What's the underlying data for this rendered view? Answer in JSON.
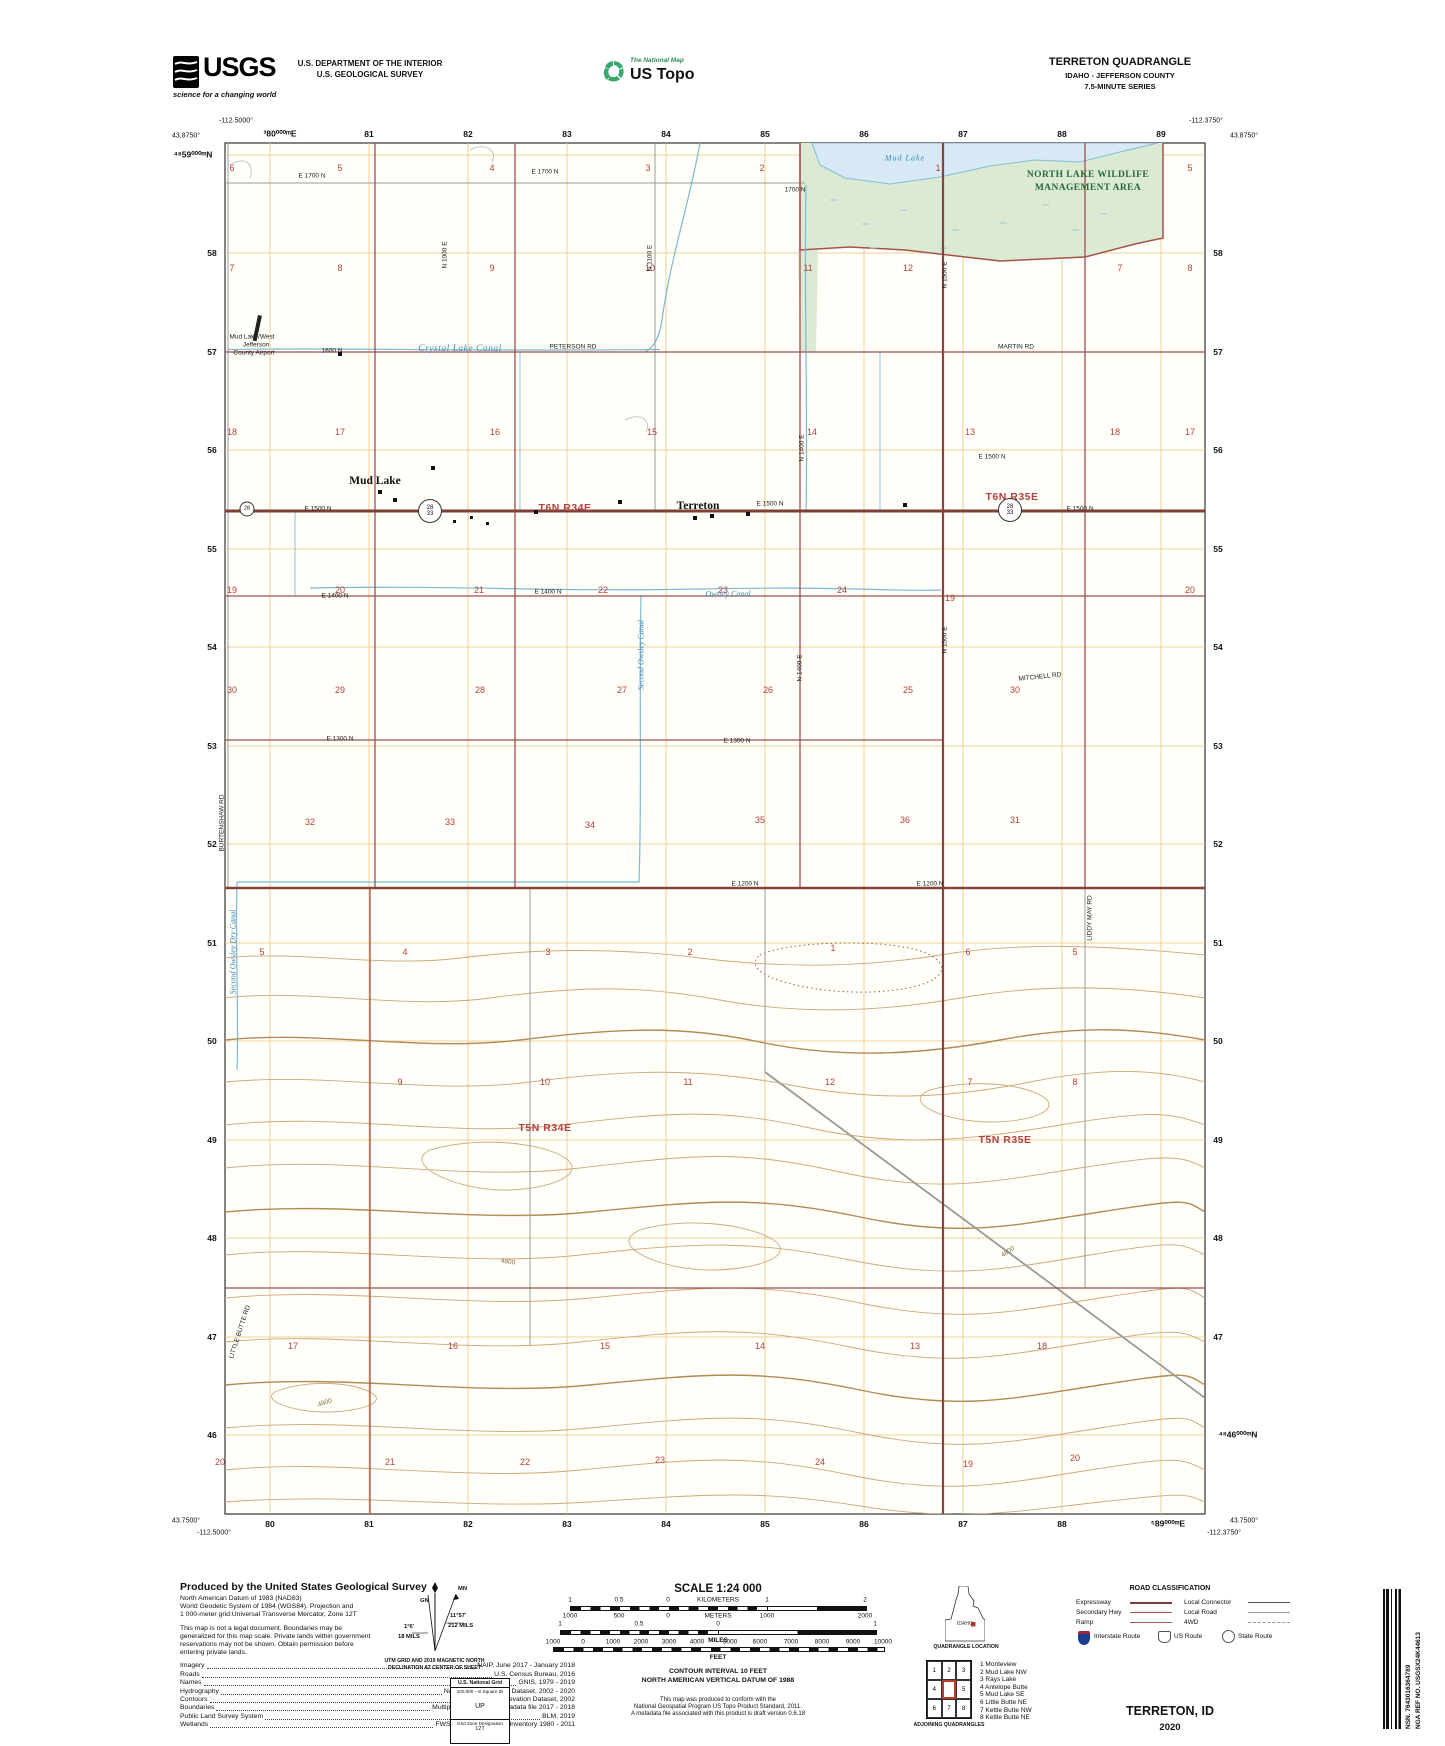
{
  "header": {
    "usgs_logo": "USGS",
    "usgs_tagline": "science for a changing world",
    "dept_line1": "U.S. DEPARTMENT OF THE INTERIOR",
    "dept_line2": "U.S. GEOLOGICAL SURVEY",
    "natmap_small": "The National Map",
    "natmap_big": "US Topo",
    "quad_title": "TERRETON QUADRANGLE",
    "quad_sub1": "IDAHO - JEFFERSON COUNTY",
    "quad_sub2": "7.5-MINUTE SERIES"
  },
  "map": {
    "corner_coords": [
      {
        "t": "-112.5000°",
        "x": 236,
        "y": 121
      },
      {
        "t": "43.8750°",
        "x": 186,
        "y": 136
      },
      {
        "t": "-112.3750°",
        "x": 1206,
        "y": 121
      },
      {
        "t": "43.8750°",
        "x": 1244,
        "y": 136
      },
      {
        "t": "43.7500°",
        "x": 186,
        "y": 1521
      },
      {
        "t": "-112.5000°",
        "x": 214,
        "y": 1533
      },
      {
        "t": "43.7500°",
        "x": 1244,
        "y": 1521
      },
      {
        "t": "-112.3750°",
        "x": 1224,
        "y": 1533
      }
    ],
    "grid_labels": [
      {
        "t": "³80⁰⁰⁰ᵐE",
        "x": 280,
        "y": 134
      },
      {
        "t": "81",
        "x": 369,
        "y": 134
      },
      {
        "t": "82",
        "x": 468,
        "y": 134
      },
      {
        "t": "83",
        "x": 567,
        "y": 134
      },
      {
        "t": "84",
        "x": 666,
        "y": 134
      },
      {
        "t": "85",
        "x": 765,
        "y": 134
      },
      {
        "t": "86",
        "x": 864,
        "y": 134
      },
      {
        "t": "87",
        "x": 963,
        "y": 134
      },
      {
        "t": "88",
        "x": 1062,
        "y": 134
      },
      {
        "t": "89",
        "x": 1161,
        "y": 134
      },
      {
        "t": "80",
        "x": 270,
        "y": 1524
      },
      {
        "t": "81",
        "x": 369,
        "y": 1524
      },
      {
        "t": "82",
        "x": 468,
        "y": 1524
      },
      {
        "t": "83",
        "x": 567,
        "y": 1524
      },
      {
        "t": "84",
        "x": 666,
        "y": 1524
      },
      {
        "t": "85",
        "x": 765,
        "y": 1524
      },
      {
        "t": "86",
        "x": 864,
        "y": 1524
      },
      {
        "t": "87",
        "x": 963,
        "y": 1524
      },
      {
        "t": "88",
        "x": 1062,
        "y": 1524
      },
      {
        "t": "⁵89⁰⁰⁰ᵐE",
        "x": 1168,
        "y": 1524
      },
      {
        "t": "⁴⁸59⁰⁰⁰ᵐN",
        "x": 193,
        "y": 155
      },
      {
        "t": "58",
        "x": 212,
        "y": 253
      },
      {
        "t": "57",
        "x": 212,
        "y": 352
      },
      {
        "t": "56",
        "x": 212,
        "y": 450
      },
      {
        "t": "55",
        "x": 212,
        "y": 549
      },
      {
        "t": "54",
        "x": 212,
        "y": 647
      },
      {
        "t": "53",
        "x": 212,
        "y": 746
      },
      {
        "t": "52",
        "x": 212,
        "y": 844
      },
      {
        "t": "51",
        "x": 212,
        "y": 943
      },
      {
        "t": "50",
        "x": 212,
        "y": 1041
      },
      {
        "t": "49",
        "x": 212,
        "y": 1140
      },
      {
        "t": "48",
        "x": 212,
        "y": 1238
      },
      {
        "t": "47",
        "x": 212,
        "y": 1337
      },
      {
        "t": "46",
        "x": 212,
        "y": 1435
      },
      {
        "t": "58",
        "x": 1218,
        "y": 253
      },
      {
        "t": "57",
        "x": 1218,
        "y": 352
      },
      {
        "t": "56",
        "x": 1218,
        "y": 450
      },
      {
        "t": "55",
        "x": 1218,
        "y": 549
      },
      {
        "t": "54",
        "x": 1218,
        "y": 647
      },
      {
        "t": "53",
        "x": 1218,
        "y": 746
      },
      {
        "t": "52",
        "x": 1218,
        "y": 844
      },
      {
        "t": "51",
        "x": 1218,
        "y": 943
      },
      {
        "t": "50",
        "x": 1218,
        "y": 1041
      },
      {
        "t": "49",
        "x": 1218,
        "y": 1140
      },
      {
        "t": "48",
        "x": 1218,
        "y": 1238
      },
      {
        "t": "47",
        "x": 1218,
        "y": 1337
      },
      {
        "t": "⁴⁸46⁰⁰⁰ᵐN",
        "x": 1238,
        "y": 1435
      }
    ],
    "sections": [
      {
        "t": "6",
        "x": 232,
        "y": 168
      },
      {
        "t": "5",
        "x": 340,
        "y": 168
      },
      {
        "t": "4",
        "x": 492,
        "y": 168
      },
      {
        "t": "3",
        "x": 648,
        "y": 168
      },
      {
        "t": "2",
        "x": 762,
        "y": 168
      },
      {
        "t": "1",
        "x": 938,
        "y": 168
      },
      {
        "t": "5",
        "x": 1190,
        "y": 168
      },
      {
        "t": "7",
        "x": 232,
        "y": 268
      },
      {
        "t": "8",
        "x": 340,
        "y": 268
      },
      {
        "t": "9",
        "x": 492,
        "y": 268
      },
      {
        "t": "10",
        "x": 650,
        "y": 268
      },
      {
        "t": "11",
        "x": 808,
        "y": 268
      },
      {
        "t": "12",
        "x": 908,
        "y": 268
      },
      {
        "t": "7",
        "x": 1120,
        "y": 268
      },
      {
        "t": "8",
        "x": 1190,
        "y": 268
      },
      {
        "t": "18",
        "x": 232,
        "y": 432
      },
      {
        "t": "17",
        "x": 340,
        "y": 432
      },
      {
        "t": "16",
        "x": 495,
        "y": 432
      },
      {
        "t": "15",
        "x": 652,
        "y": 432
      },
      {
        "t": "14",
        "x": 812,
        "y": 432
      },
      {
        "t": "13",
        "x": 970,
        "y": 432
      },
      {
        "t": "18",
        "x": 1115,
        "y": 432
      },
      {
        "t": "17",
        "x": 1190,
        "y": 432
      },
      {
        "t": "19",
        "x": 232,
        "y": 590
      },
      {
        "t": "20",
        "x": 340,
        "y": 590
      },
      {
        "t": "21",
        "x": 479,
        "y": 590
      },
      {
        "t": "22",
        "x": 603,
        "y": 590
      },
      {
        "t": "23",
        "x": 723,
        "y": 590
      },
      {
        "t": "24",
        "x": 842,
        "y": 590
      },
      {
        "t": "19",
        "x": 950,
        "y": 598
      },
      {
        "t": "20",
        "x": 1190,
        "y": 590
      },
      {
        "t": "30",
        "x": 232,
        "y": 690
      },
      {
        "t": "29",
        "x": 340,
        "y": 690
      },
      {
        "t": "28",
        "x": 480,
        "y": 690
      },
      {
        "t": "27",
        "x": 622,
        "y": 690
      },
      {
        "t": "26",
        "x": 768,
        "y": 690
      },
      {
        "t": "25",
        "x": 908,
        "y": 690
      },
      {
        "t": "30",
        "x": 1015,
        "y": 690
      },
      {
        "t": "32",
        "x": 310,
        "y": 822
      },
      {
        "t": "33",
        "x": 450,
        "y": 822
      },
      {
        "t": "34",
        "x": 590,
        "y": 825
      },
      {
        "t": "35",
        "x": 760,
        "y": 820
      },
      {
        "t": "36",
        "x": 905,
        "y": 820
      },
      {
        "t": "31",
        "x": 1015,
        "y": 820
      },
      {
        "t": "5",
        "x": 262,
        "y": 952
      },
      {
        "t": "4",
        "x": 405,
        "y": 952
      },
      {
        "t": "3",
        "x": 548,
        "y": 952
      },
      {
        "t": "2",
        "x": 690,
        "y": 952
      },
      {
        "t": "1",
        "x": 833,
        "y": 948
      },
      {
        "t": "6",
        "x": 968,
        "y": 952
      },
      {
        "t": "5",
        "x": 1075,
        "y": 952
      },
      {
        "t": "9",
        "x": 400,
        "y": 1082
      },
      {
        "t": "10",
        "x": 545,
        "y": 1082
      },
      {
        "t": "11",
        "x": 688,
        "y": 1082
      },
      {
        "t": "12",
        "x": 830,
        "y": 1082
      },
      {
        "t": "7",
        "x": 970,
        "y": 1082
      },
      {
        "t": "8",
        "x": 1075,
        "y": 1082
      },
      {
        "t": "17",
        "x": 293,
        "y": 1346
      },
      {
        "t": "16",
        "x": 453,
        "y": 1346
      },
      {
        "t": "15",
        "x": 605,
        "y": 1346
      },
      {
        "t": "14",
        "x": 760,
        "y": 1346
      },
      {
        "t": "13",
        "x": 915,
        "y": 1346
      },
      {
        "t": "18",
        "x": 1042,
        "y": 1346
      },
      {
        "t": "20",
        "x": 220,
        "y": 1462
      },
      {
        "t": "21",
        "x": 390,
        "y": 1462
      },
      {
        "t": "22",
        "x": 525,
        "y": 1462
      },
      {
        "t": "23",
        "x": 660,
        "y": 1460
      },
      {
        "t": "24",
        "x": 820,
        "y": 1462
      },
      {
        "t": "19",
        "x": 968,
        "y": 1464
      },
      {
        "t": "20",
        "x": 1075,
        "y": 1458
      }
    ],
    "townships": [
      {
        "t": "T6N R34E",
        "x": 565,
        "y": 508
      },
      {
        "t": "T6N R35E",
        "x": 1012,
        "y": 497
      },
      {
        "t": "T5N R34E",
        "x": 545,
        "y": 1128
      },
      {
        "t": "T5N R35E",
        "x": 1005,
        "y": 1140
      }
    ],
    "places": [
      {
        "t": "Mud Lake",
        "x": 375,
        "y": 481
      },
      {
        "t": "Terreton",
        "x": 698,
        "y": 506
      }
    ],
    "water": [
      {
        "t": "Mud Lake",
        "x": 905,
        "y": 158,
        "c": "lake"
      },
      {
        "t": "Crystal Lake Canal",
        "x": 460,
        "y": 349,
        "c": "canalbig"
      },
      {
        "t": "Owsley Canal",
        "x": 728,
        "y": 594,
        "c": "canal"
      },
      {
        "t": "Second Owsley Canal",
        "x": 641,
        "y": 655,
        "c": "canal",
        "r": -90
      },
      {
        "t": "Second Owsley Dry Canal",
        "x": 233,
        "y": 952,
        "c": "canal",
        "r": -90
      }
    ],
    "areas": [
      {
        "t": "NORTH LAKE WILDLIFE",
        "x": 1088,
        "y": 175
      },
      {
        "t": "MANAGEMENT AREA",
        "x": 1088,
        "y": 188
      }
    ],
    "roads": [
      {
        "t": "E 1700 N",
        "x": 312,
        "y": 176
      },
      {
        "t": "E 1700 N",
        "x": 545,
        "y": 172
      },
      {
        "t": "1700 N",
        "x": 795,
        "y": 190
      },
      {
        "t": "Mud Lake/West",
        "x": 252,
        "y": 337
      },
      {
        "t": "Jefferson",
        "x": 256,
        "y": 345
      },
      {
        "t": "County Airport",
        "x": 254,
        "y": 353
      },
      {
        "t": "1600 N",
        "x": 332,
        "y": 351
      },
      {
        "t": "PETERSON RD",
        "x": 573,
        "y": 347
      },
      {
        "t": "MARTIN RD",
        "x": 1016,
        "y": 347
      },
      {
        "t": "E 1500 N",
        "x": 318,
        "y": 509
      },
      {
        "t": "E 1500 N",
        "x": 770,
        "y": 504
      },
      {
        "t": "E 1500 N",
        "x": 1080,
        "y": 509
      },
      {
        "t": "E 1500 N",
        "x": 992,
        "y": 457
      },
      {
        "t": "E 1400 N",
        "x": 335,
        "y": 596
      },
      {
        "t": "E 1400 N",
        "x": 548,
        "y": 592
      },
      {
        "t": "E 1300 N",
        "x": 340,
        "y": 739
      },
      {
        "t": "E 1300 N",
        "x": 737,
        "y": 741
      },
      {
        "t": "E 1200 N",
        "x": 930,
        "y": 884
      },
      {
        "t": "E 1200 N",
        "x": 745,
        "y": 884
      },
      {
        "t": "MITCHELL RD",
        "x": 1040,
        "y": 677,
        "r": -6
      },
      {
        "t": "BURTENSHAW RD",
        "x": 222,
        "y": 823,
        "r": -90
      },
      {
        "t": "LIDDY MAY RD",
        "x": 1090,
        "y": 918,
        "r": -90
      },
      {
        "t": "LITTLE BUTTE RD",
        "x": 240,
        "y": 1332,
        "r": -72
      },
      {
        "t": "N 1000 E",
        "x": 445,
        "y": 255,
        "r": -90
      },
      {
        "t": "N 1100 E",
        "x": 650,
        "y": 258,
        "r": -90
      },
      {
        "t": "N 1400 E",
        "x": 802,
        "y": 448,
        "r": -90
      },
      {
        "t": "N 1500 E",
        "x": 945,
        "y": 275,
        "r": -90
      },
      {
        "t": "N 1400 E",
        "x": 800,
        "y": 668,
        "r": -90
      },
      {
        "t": "N 1500 E",
        "x": 945,
        "y": 640,
        "r": -90
      }
    ],
    "contour_labels": [
      {
        "t": "4800",
        "x": 508,
        "y": 1262,
        "r": 8
      },
      {
        "t": "4900",
        "x": 325,
        "y": 1403,
        "r": -20
      },
      {
        "t": "4800",
        "x": 1008,
        "y": 1252,
        "r": -35
      }
    ],
    "shields": {
      "a_top": "28",
      "a_bot": "33",
      "b_top": "28",
      "b_bot": "33",
      "small": "28"
    }
  },
  "footer": {
    "produced_title": "Produced by the United States Geological Survey",
    "intro": [
      {
        "t": "North American Datum of 1983 (NAD83)"
      },
      {
        "t": "World Geodetic System of 1984 (WGS84).  Projection and"
      },
      {
        "t": "1 000-meter grid:Universal Transverse Mercator, Zone 12T"
      },
      {
        "t": "This map is not a legal document. Boundaries may be",
        "c": "gap"
      },
      {
        "t": "generalized for this map scale. Private lands within government"
      },
      {
        "t": "reservations may not be shown. Obtain permission before"
      },
      {
        "t": "entering private lands."
      }
    ],
    "credits": [
      {
        "k": "Imagery",
        "v": "NAIP, June 2017 - January 2018"
      },
      {
        "k": "Roads",
        "v": "U.S. Census Bureau, 2016"
      },
      {
        "k": "Names",
        "v": "GNIS, 1979 - 2019"
      },
      {
        "k": "Hydrography",
        "v": "National Hydrography Dataset, 2002 - 2020"
      },
      {
        "k": "Contours",
        "v": "National Elevation Dataset, 2002"
      },
      {
        "k": "Boundaries",
        "v": "Multiple sources; see metadata file 2017 - 2018"
      },
      {
        "k": "Public Land Survey System",
        "v": "BLM, 2019"
      },
      {
        "k": "Wetlands",
        "v": "FWS National Wetlands Inventory 1980 - 2011"
      }
    ]
  },
  "declination": {
    "star": "★",
    "gn": "GN",
    "mn": "MN",
    "ang1": "1°6'",
    "mils1": "18 MILS",
    "ang2": "11°57'",
    "mils2": "212 MILS",
    "cap1": "UTM GRID AND 2019 MAGNETIC NORTH",
    "cap2": "DECLINATION AT CENTER OF SHEET"
  },
  "usng": {
    "title": "U.S. National Grid",
    "sq": "100,000 - m Square ID",
    "id": "UP",
    "gzd": "Grid Zone Designation",
    "zone": "12T"
  },
  "scale": {
    "title": "SCALE 1:24 000",
    "km": [
      {
        "t": "1",
        "x": 570
      },
      {
        "t": "0.5",
        "x": 619
      },
      {
        "t": "0",
        "x": 668
      },
      {
        "t": "KILOMETERS",
        "x": 718
      },
      {
        "t": "1",
        "x": 767
      },
      {
        "t": "2",
        "x": 865
      }
    ],
    "m": [
      {
        "t": "1000",
        "x": 570
      },
      {
        "t": "500",
        "x": 619
      },
      {
        "t": "0",
        "x": 668
      },
      {
        "t": "METERS",
        "x": 718
      },
      {
        "t": "1000",
        "x": 767
      },
      {
        "t": "2000",
        "x": 865
      }
    ],
    "mi": [
      {
        "t": "1",
        "x": 560
      },
      {
        "t": "0.5",
        "x": 639
      },
      {
        "t": "0",
        "x": 718
      },
      {
        "t": "1",
        "x": 875
      }
    ],
    "mi_cap": "MILES",
    "ft": [
      {
        "t": "1000",
        "x": 553
      },
      {
        "t": "0",
        "x": 583
      },
      {
        "t": "1000",
        "x": 613
      },
      {
        "t": "2000",
        "x": 641
      },
      {
        "t": "3000",
        "x": 669
      },
      {
        "t": "4000",
        "x": 697
      },
      {
        "t": "5000",
        "x": 730
      },
      {
        "t": "6000",
        "x": 760
      },
      {
        "t": "7000",
        "x": 791
      },
      {
        "t": "8000",
        "x": 822
      },
      {
        "t": "9000",
        "x": 853
      },
      {
        "t": "10000",
        "x": 883
      }
    ],
    "ft_cap": "FEET",
    "contour1": "CONTOUR INTERVAL 10 FEET",
    "contour2": "NORTH AMERICAN VERTICAL DATUM OF 1988",
    "conform1": "This map was produced to conform with the",
    "conform2": "National Geospatial Program US Topo Product Standard, 2011.",
    "conform3": "A metadata file associated with this product is draft version 0.6.18"
  },
  "location": {
    "state": "IDAHO",
    "caption": "QUADRANGLE LOCATION"
  },
  "adjoining": {
    "caption": "ADJOINING QUADRANGLES",
    "cells": [
      "1",
      "2",
      "3",
      "4",
      "5",
      "6",
      "7",
      "8"
    ],
    "list": [
      {
        "t": "1 Monteview"
      },
      {
        "t": "2 Mud Lake NW"
      },
      {
        "t": "3 Rays Lake"
      },
      {
        "t": "4 Antelope Butte"
      },
      {
        "t": "5 Mud Lake SE"
      },
      {
        "t": "6 Little Butte NE"
      },
      {
        "t": "7 Kettle Butte NW"
      },
      {
        "t": "8 Kettle Butte NE"
      }
    ]
  },
  "road_class": {
    "title": "ROAD CLASSIFICATION",
    "l1": "Expressway",
    "l2": "Secondary Hwy",
    "l3": "Ramp",
    "r1": "Local Connector",
    "r2": "Local Road",
    "r3": "4WD",
    "s1": "Interstate Route",
    "s2": "US Route",
    "s3": "State Route"
  },
  "barcode": {
    "nsn": "NSN. 7643016364789",
    "nga": "NGA REF NO. USGSX24K44613"
  },
  "imprint": {
    "name": "TERRETON,  ID",
    "year": "2020"
  }
}
